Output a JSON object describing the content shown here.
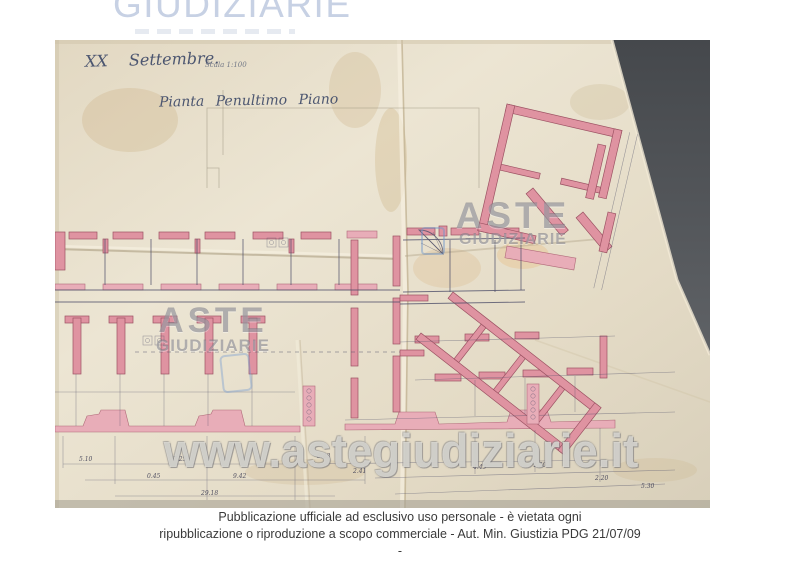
{
  "header": {
    "logo_text": "GIUDIZIARIE"
  },
  "plan": {
    "date": "XX Settembre.",
    "scale": "Scala 1:100",
    "title": "Pianta Penultimo Piano",
    "dimensions": [
      {
        "t": "5.10",
        "x": 24,
        "y": 421
      },
      {
        "t": "7.25",
        "x": 118,
        "y": 421
      },
      {
        "t": "5.48",
        "x": 262,
        "y": 418
      },
      {
        "t": "0.45",
        "x": 92,
        "y": 438
      },
      {
        "t": "9.42",
        "x": 178,
        "y": 438
      },
      {
        "t": "29.18",
        "x": 146,
        "y": 455
      },
      {
        "t": "2.41",
        "x": 298,
        "y": 433
      },
      {
        "t": "4.45",
        "x": 418,
        "y": 429
      },
      {
        "t": "1.30",
        "x": 478,
        "y": 427
      },
      {
        "t": "2.20",
        "x": 540,
        "y": 440
      },
      {
        "t": "5.30",
        "x": 586,
        "y": 448
      }
    ]
  },
  "watermarks": {
    "aste": "ASTE",
    "giudiziarie": "GIUDIZIARIE",
    "url": "www.astegiudiziarie.it"
  },
  "footer": {
    "line1": "Pubblicazione ufficiale ad esclusivo uso personale - è vietata ogni",
    "line2": "ripubblicazione o riproduzione a scopo commerciale - Aut. Min. Giustizia PDG 21/07/09",
    "line3": "-"
  },
  "colors": {
    "logo_blue": "#c7d1e4",
    "paper_cream": "#e7dfcb",
    "wall_pink": "#df93a1",
    "ink_line": "#50506a",
    "background_gray": "#4c4f53",
    "watermark_gray": "#787884",
    "caption_text": "#3a3a3a"
  }
}
